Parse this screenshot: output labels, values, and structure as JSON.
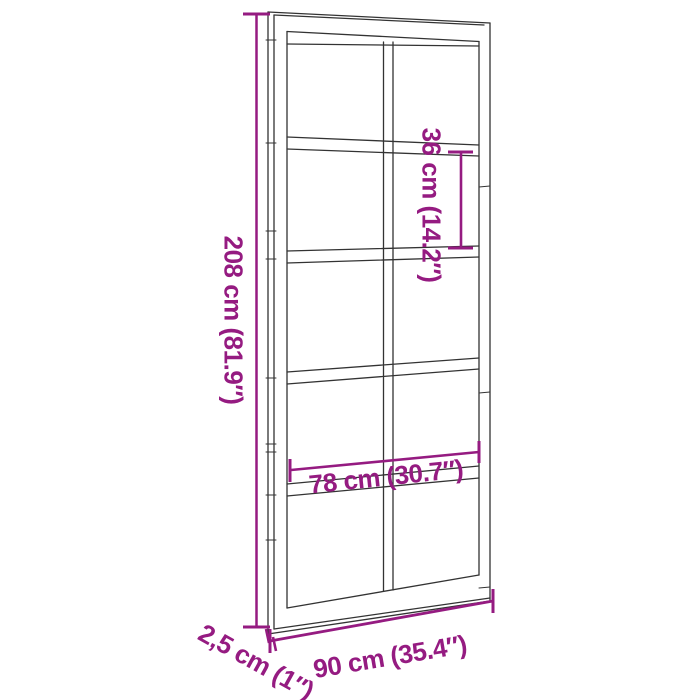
{
  "canvas": {
    "background_color": "#FFFFFF",
    "width_px": 700,
    "height_px": 700
  },
  "diagram": {
    "type": "product-dimension-diagram",
    "subject": "barn door with glass panel grid",
    "accent_color": "#951B81",
    "line_color": "#333333",
    "door": {
      "panel_columns": 2,
      "panel_rows": 5
    },
    "dimensions": [
      {
        "id": "door-height",
        "label": "208 cm (81.9″)",
        "value_cm": "208 cm",
        "value_inch": "81.9″",
        "orientation": "vertical"
      },
      {
        "id": "panel-height",
        "label": "36 cm (14.2″)",
        "value_cm": "36 cm",
        "value_inch": "14.2″",
        "orientation": "vertical"
      },
      {
        "id": "inner-width",
        "label": "78 cm (30.7″)",
        "value_cm": "78 cm",
        "value_inch": "30.7″",
        "orientation": "horizontal"
      },
      {
        "id": "door-width",
        "label": "90 cm (35.4″)",
        "value_cm": "90 cm",
        "value_inch": "35.4″",
        "orientation": "horizontal"
      },
      {
        "id": "door-thickness",
        "label": "2,5 cm (1″)",
        "value_cm": "2,5 cm",
        "value_inch": "1″",
        "orientation": "diagonal"
      }
    ]
  }
}
